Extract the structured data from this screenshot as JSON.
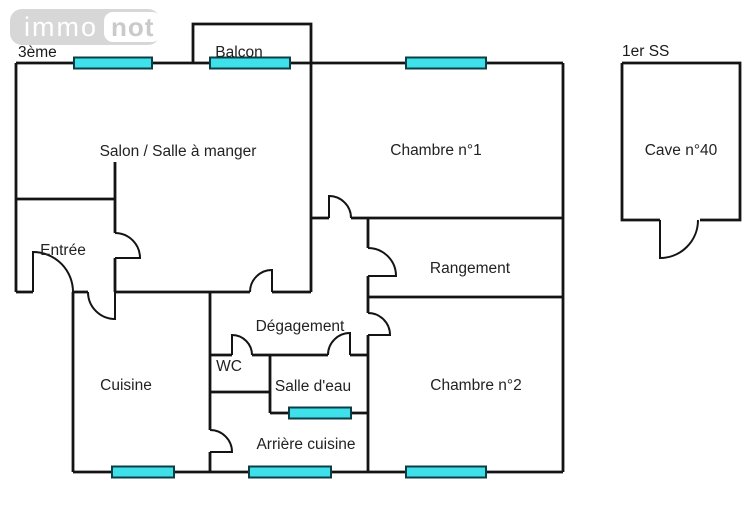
{
  "logo": {
    "part1": "immo",
    "part2": "not"
  },
  "plan": {
    "floor_label": "3ème",
    "rooms": {
      "balcon": "Balcon",
      "salon": "Salon / Salle à manger",
      "chambre1": "Chambre n°1",
      "entree": "Entrée",
      "rangement": "Rangement",
      "degagement": "Dégagement",
      "wc": "WC",
      "salle_deau": "Salle d'eau",
      "cuisine": "Cuisine",
      "arriere_cuisine": "Arrière cuisine",
      "chambre2": "Chambre n°2"
    }
  },
  "annex": {
    "floor_label": "1er SS",
    "room": "Cave n°40"
  },
  "colors": {
    "window_fill": "#3EE1E9",
    "wall": "#141414"
  }
}
